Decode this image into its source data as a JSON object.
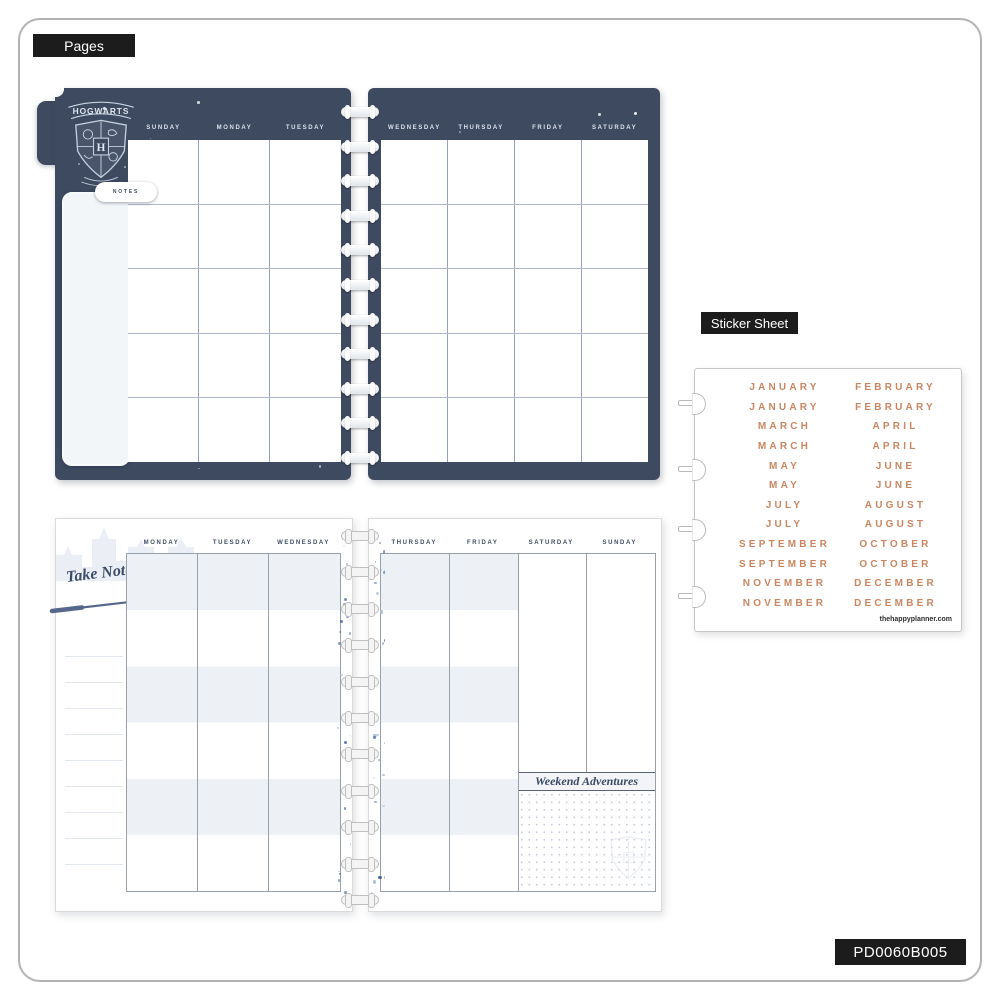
{
  "labels": {
    "pages": "Pages",
    "sticker_sheet": "Sticker Sheet"
  },
  "frame": {
    "sku": "PD0060B005"
  },
  "monthly_spread": {
    "crest_title": "HOGWARTS",
    "crest_initial": "H",
    "notes_tab": "NOTES",
    "left_day_headers": [
      "SUNDAY",
      "MONDAY",
      "TUESDAY"
    ],
    "right_day_headers": [
      "WEDNESDAY",
      "THURSDAY",
      "FRIDAY",
      "SATURDAY"
    ]
  },
  "weekly_spread": {
    "take_note": "Take Note",
    "left_day_headers": [
      "MONDAY",
      "TUESDAY",
      "WEDNESDAY"
    ],
    "right_day_headers": [
      "THURSDAY",
      "FRIDAY",
      "SATURDAY",
      "SUNDAY"
    ],
    "weekend_section": "Weekend Adventures"
  },
  "sticker_sheet": {
    "months": [
      [
        "JANUARY",
        "FEBRUARY"
      ],
      [
        "JANUARY",
        "FEBRUARY"
      ],
      [
        "MARCH",
        "APRIL"
      ],
      [
        "MARCH",
        "APRIL"
      ],
      [
        "MAY",
        "JUNE"
      ],
      [
        "MAY",
        "JUNE"
      ],
      [
        "JULY",
        "AUGUST"
      ],
      [
        "JULY",
        "AUGUST"
      ],
      [
        "SEPTEMBER",
        "OCTOBER"
      ],
      [
        "SEPTEMBER",
        "OCTOBER"
      ],
      [
        "NOVEMBER",
        "DECEMBER"
      ],
      [
        "NOVEMBER",
        "DECEMBER"
      ]
    ],
    "website": "thehappyplanner.com"
  },
  "colors": {
    "navy": "#3e4a60",
    "copper": "#ca8660",
    "badge_black": "#1c1c1c",
    "band_gray": "#edf1f5",
    "grid_line": "#96a1bd"
  }
}
